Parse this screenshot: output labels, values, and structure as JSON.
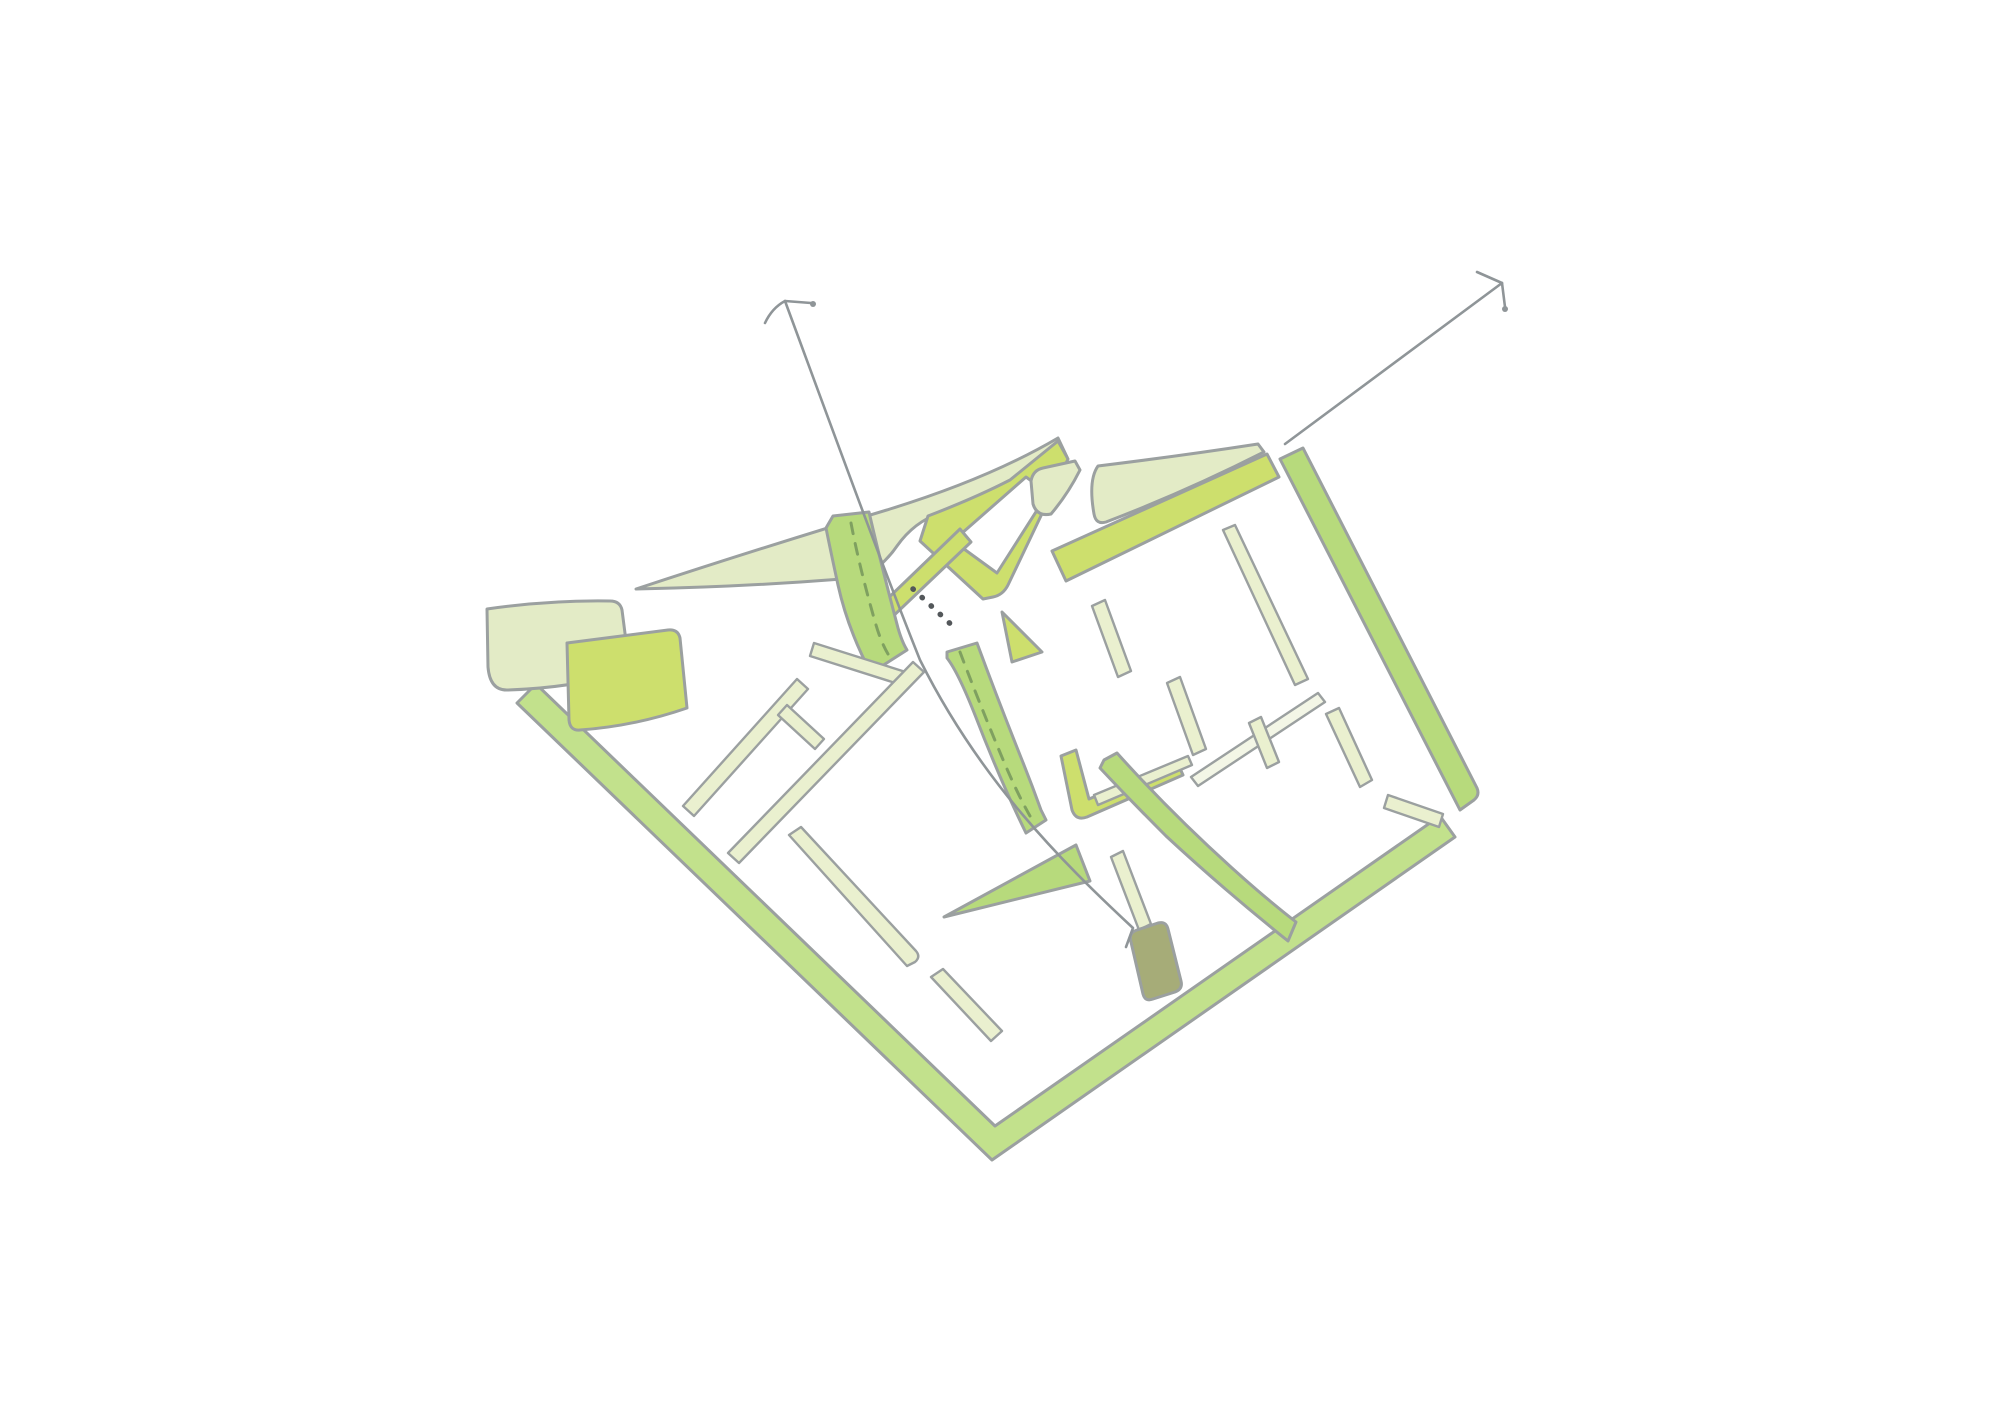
{
  "page": {
    "kind": "hand-drawn architectural site plan concept sketch",
    "background": "#ffffff"
  },
  "colors": {
    "background": "#ffffff",
    "white": "#ffffff",
    "pale": "#e3ebc6",
    "pale_strip": "#eaf0cf",
    "white_strip": "#f3f6e6",
    "chartreuse": "#cddf6d",
    "green": "#b7da7c",
    "boundary_green": "#c2e18c",
    "dark_olive": "#a6ac78",
    "outline": "#9ba0a0",
    "arrow": "#8f9598",
    "dash_green": "#7fa060",
    "dot_gray": "#53575a"
  },
  "sketch": {
    "shapes": [
      {
        "name": "site-boundary-bottom",
        "color": "boundary_green",
        "role": "green perimeter strip (left-bottom and right-bottom edges of tilted square site)"
      },
      {
        "name": "site-boundary-right",
        "color": "green",
        "role": "green perimeter strip, right edge"
      },
      {
        "name": "pale-wedge-far-left",
        "color": "pale",
        "role": "block at west corner"
      },
      {
        "name": "chartreuse-quad-left",
        "color": "chartreuse",
        "role": "green space parcel"
      },
      {
        "name": "pale-hat",
        "color": "pale",
        "role": "large curved block along top edge"
      },
      {
        "name": "courtyard-band",
        "color": "chartreuse",
        "role": "angular band enclosing white courtyard"
      },
      {
        "name": "curved-canal-band",
        "color": "green",
        "role": "curved band with dashed centerline"
      },
      {
        "name": "tapering-canal-wedge",
        "color": "green",
        "role": "tapering band with dashed centerline"
      },
      {
        "name": "green-triangle",
        "color": "green",
        "role": "triangular parcel"
      },
      {
        "name": "street-edge-strips",
        "color": "pale_strip",
        "role": "thin wall / street edge strips"
      },
      {
        "name": "top-edge-band-right-block",
        "color": "chartreuse",
        "role": "band along top edge of east block"
      },
      {
        "name": "l-courtyard-band",
        "color": "chartreuse",
        "role": "L-shaped courtyard band"
      },
      {
        "name": "main-street-band",
        "color": "green",
        "role": "band along central diagonal street"
      },
      {
        "name": "building-marker",
        "color": "dark_olive",
        "role": "small dark building block"
      }
    ],
    "arrows": [
      {
        "name": "arrow-northwest",
        "role": "sketched sightline arrow pointing up from site centre"
      },
      {
        "name": "arrow-northeast",
        "role": "sketched sightline arrow pointing up-right from north corner"
      }
    ],
    "linework": [
      {
        "name": "dotted-desire-line",
        "style": "dotted"
      },
      {
        "name": "canal-dashed-centerlines",
        "style": "dashed"
      }
    ]
  }
}
